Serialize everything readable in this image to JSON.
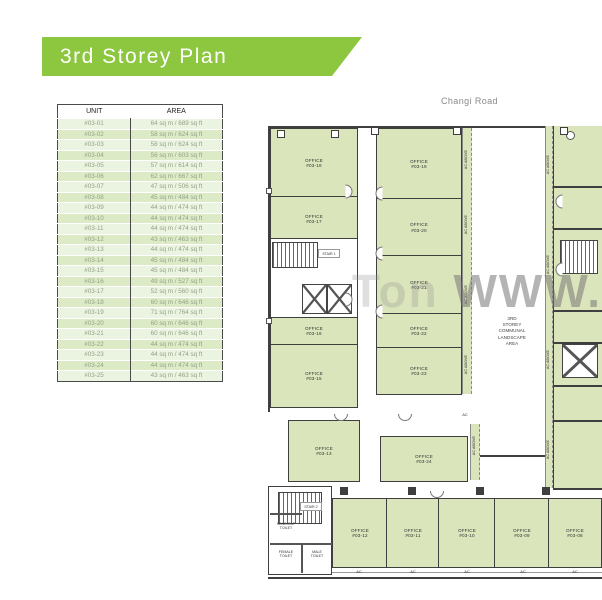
{
  "banner": {
    "title": "3rd Storey Plan",
    "bg": "#8dc63f"
  },
  "road_label": "Changi Road",
  "watermark": {
    "faint": "Ton",
    "main": "WWW."
  },
  "area_table": {
    "headers": {
      "unit": "UNIT",
      "area": "AREA"
    },
    "rows": [
      {
        "unit": "#03-01",
        "area": "64 sq m / 689 sq ft"
      },
      {
        "unit": "#03-02",
        "area": "58 sq m / 624 sq ft"
      },
      {
        "unit": "#03-03",
        "area": "58 sq m / 624 sq ft"
      },
      {
        "unit": "#03-04",
        "area": "56 sq m / 603 sq ft"
      },
      {
        "unit": "#03-05",
        "area": "57 sq m / 614 sq ft"
      },
      {
        "unit": "#03-06",
        "area": "62 sq m / 667 sq ft"
      },
      {
        "unit": "#03-07",
        "area": "47 sq m / 506 sq ft"
      },
      {
        "unit": "#03-08",
        "area": "45 sq m / 484 sq ft"
      },
      {
        "unit": "#03-09",
        "area": "44 sq m / 474 sq ft"
      },
      {
        "unit": "#03-10",
        "area": "44 sq m / 474 sq ft"
      },
      {
        "unit": "#03-11",
        "area": "44 sq m / 474 sq ft"
      },
      {
        "unit": "#03-12",
        "area": "43 sq m / 463 sq ft"
      },
      {
        "unit": "#03-13",
        "area": "44 sq m / 474 sq ft"
      },
      {
        "unit": "#03-14",
        "area": "45 sq m / 484 sq ft"
      },
      {
        "unit": "#03-15",
        "area": "45 sq m / 484 sq ft"
      },
      {
        "unit": "#03-16",
        "area": "49 sq m / 527 sq ft"
      },
      {
        "unit": "#03-17",
        "area": "52 sq m / 560 sq ft"
      },
      {
        "unit": "#03-18",
        "area": "60 sq m / 646 sq ft"
      },
      {
        "unit": "#03-19",
        "area": "71 sq m / 764 sq ft"
      },
      {
        "unit": "#03-20",
        "area": "60 sq m / 646 sq ft"
      },
      {
        "unit": "#03-21",
        "area": "60 sq m / 646 sq ft"
      },
      {
        "unit": "#03-22",
        "area": "44 sq m / 474 sq ft"
      },
      {
        "unit": "#03-23",
        "area": "44 sq m / 474 sq ft"
      },
      {
        "unit": "#03-24",
        "area": "44 sq m / 474 sq ft"
      },
      {
        "unit": "#03-25",
        "area": "43 sq m / 463 sq ft"
      }
    ]
  },
  "plan": {
    "office_word": "OFFICE",
    "units": {
      "u18": "#03-18",
      "u17": "#03-17",
      "u16": "#03-16",
      "u15": "#03-15",
      "u19": "#03-19",
      "u20": "#03-20",
      "u21": "#03-21",
      "u22": "#03-22",
      "u23": "#03-23",
      "u13": "#03-13",
      "u24": "#03-24",
      "u12": "#03-12",
      "u11": "#03-11",
      "u10": "#03-10",
      "u09": "#03-09",
      "u08": "#03-08"
    },
    "labels": {
      "ac": "AC",
      "ac_above": "AC ABOVE",
      "stair1": "STAIR 1",
      "stair2": "STAIR 2",
      "handicap_toilet": "HANDICAP\nTOILET",
      "female_toilet": "FEMALE\nTOILET",
      "male_toilet": "MALE\nTOILET",
      "communal": "3RD\nSTOREY\nCOMMUNAL\nLANDSCAPE\nAREA"
    }
  }
}
